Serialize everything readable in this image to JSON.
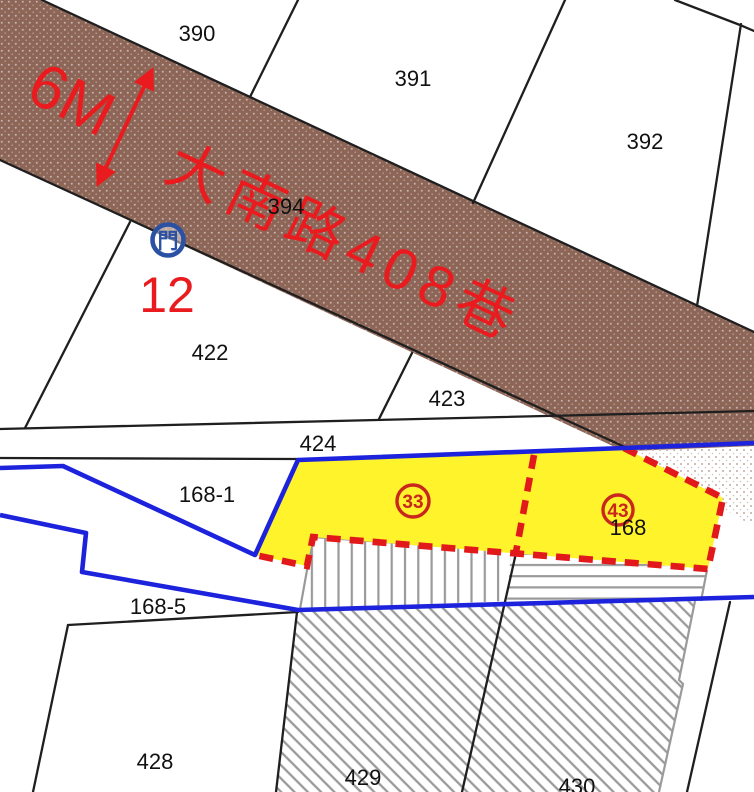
{
  "map": {
    "road": {
      "name": "大南路408巷",
      "width_label": "6M",
      "gate_symbol": "門",
      "address_label": "12"
    },
    "parcels": {
      "p390": "390",
      "p391": "391",
      "p392": "392",
      "p394": "394",
      "p422": "422",
      "p423": "423",
      "p424": "424",
      "p168_1": "168-1",
      "p168_5": "168-5",
      "p428": "428",
      "p429": "429",
      "p430": "430",
      "p168": "168"
    },
    "markers": {
      "m33": "33",
      "m43": "43"
    },
    "colors": {
      "road_brown": "#8D6658",
      "parcel_yellow": "#FFF32B",
      "boundary_blue": "#1D23DC",
      "gate_blue": "#2B51A4",
      "annotation_red": "#EA1B1E",
      "dashed_red": "#E2191B",
      "marker_red": "#C9271E",
      "hatch_gray": "#9A9A9A",
      "line_black": "#1F1F1F"
    }
  }
}
